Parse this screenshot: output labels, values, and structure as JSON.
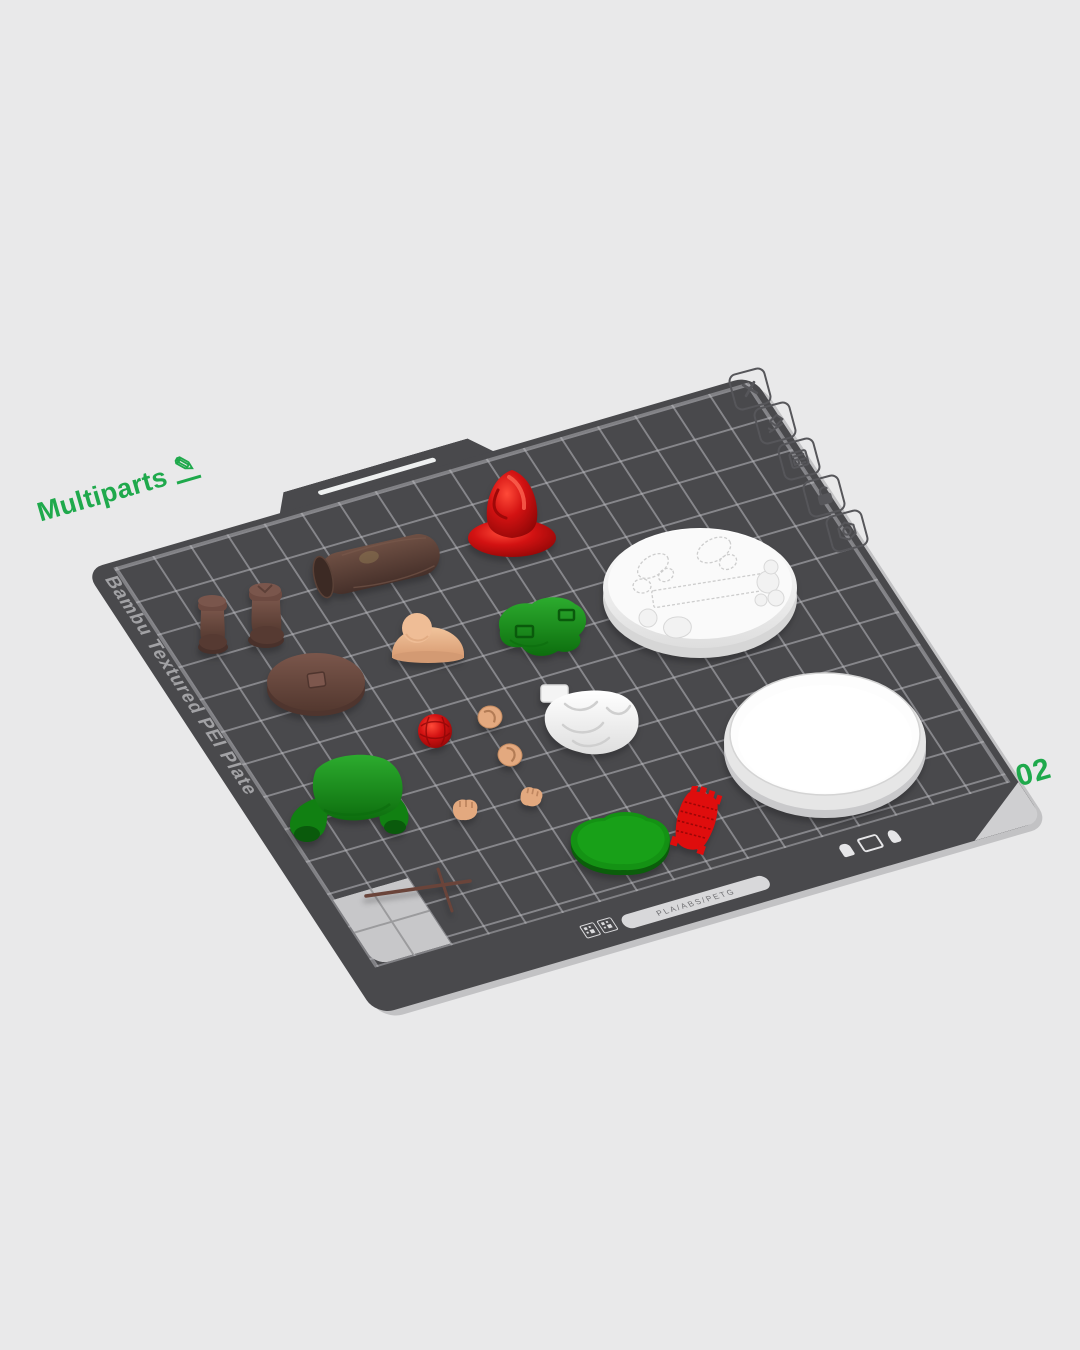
{
  "scene": {
    "background_color": "#e9e9ea",
    "project_label": "Multiparts",
    "edit_glyph": "✎",
    "plate_number": "02",
    "accent_green": "#1fa94c"
  },
  "plate": {
    "brand_text": "Bambu Textured PEI Plate",
    "material_text": "PLA/ABS/PETG",
    "surface_color": "#49494c",
    "grid_line_color": "#b9b9be",
    "corner_marker_color": "#c7c7c9"
  },
  "toolbar": {
    "items": [
      {
        "name": "delete-plate",
        "icon": "close-icon"
      },
      {
        "name": "rename-plate",
        "icon": "edit-plate-icon"
      },
      {
        "name": "arrange-plate",
        "icon": "layout-icon"
      },
      {
        "name": "lock-plate",
        "icon": "unlock-icon"
      },
      {
        "name": "plate-settings",
        "icon": "nut-icon"
      }
    ]
  },
  "parts": [
    {
      "name": "gnome-hat",
      "color": "#d31212"
    },
    {
      "name": "log",
      "color": "#5d4338"
    },
    {
      "name": "boot-left",
      "color": "#5d4038"
    },
    {
      "name": "boot-right",
      "color": "#5d4038"
    },
    {
      "name": "base-with-footprints",
      "color": "#f6f6f6"
    },
    {
      "name": "nose-and-cheeks",
      "color": "#e8b58d"
    },
    {
      "name": "legs-with-buckles",
      "color": "#178617"
    },
    {
      "name": "round-base-brown",
      "color": "#6e4a42"
    },
    {
      "name": "yarn-ball",
      "color": "#cf0e0e"
    },
    {
      "name": "ear-left",
      "color": "#e2a87f"
    },
    {
      "name": "ear-right",
      "color": "#e2a87f"
    },
    {
      "name": "hand-left",
      "color": "#e2a87f"
    },
    {
      "name": "hand-right",
      "color": "#e2a87f"
    },
    {
      "name": "beard",
      "color": "#f6f6f6"
    },
    {
      "name": "coat",
      "color": "#15860f"
    },
    {
      "name": "oval-base-green",
      "color": "#149214"
    },
    {
      "name": "knitted-patch",
      "color": "#dd0f0f"
    },
    {
      "name": "knitting-needles",
      "color": "#6a443a"
    }
  ]
}
